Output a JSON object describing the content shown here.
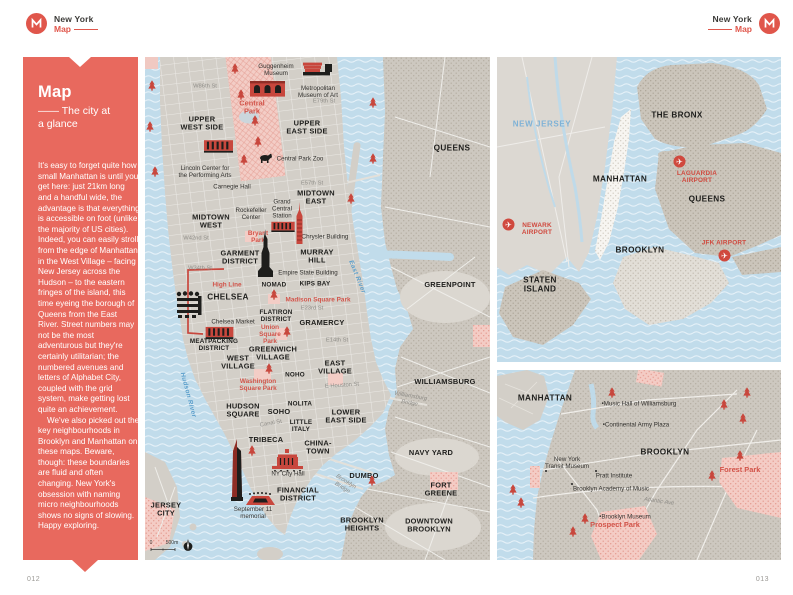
{
  "colors": {
    "accent_red": "#E0564B",
    "sidebar_bg": "#E8695E",
    "water_blue": "#C1DCEB",
    "park_pink": "#F3CDC6",
    "label_red": "#D0493E",
    "water_text_blue": "#5C9FCB"
  },
  "brand": {
    "title": "New York",
    "sub": "Map"
  },
  "pages": {
    "left": "012",
    "right": "013"
  },
  "sidebar": {
    "title": "Map",
    "subtitle": "—— The city at a glance",
    "para1": "It's easy to forget quite how small Manhattan is until you get here: just 21km long and a handful wide, the advantage is that everything is accessible on foot (unlike the majority of US cities). Indeed, you can easily stroll from the edge of Manhattan in the West Village – facing New Jersey across the Hudson – to the eastern fringes of the island, this time eyeing the borough of Queens from the East River. Street numbers may not be the most adventurous but they're certainly utilitarian; the numbered avenues and letters of Alphabet City, coupled with the grid system, make getting lost quite an achievement.",
    "para2": "We've also picked out the key neighbourhoods in Brooklyn and Manhattan on these maps. Beware, though: these boundaries are fluid and often changing. New York's obsession with naming micro neighbourhoods shows no signs of slowing. Happy exploring."
  },
  "main_map": {
    "labels": [
      {
        "t": "UPPER\nWEST SIDE",
        "x": 57,
        "y": 67,
        "c": "n"
      },
      {
        "t": "UPPER\nEAST SIDE",
        "x": 162,
        "y": 71,
        "c": "n"
      },
      {
        "t": "QUEENS",
        "x": 307,
        "y": 91,
        "c": "n2"
      },
      {
        "t": "MIDTOWN\nEAST",
        "x": 171,
        "y": 141,
        "c": "n"
      },
      {
        "t": "MIDTOWN\nWEST",
        "x": 66,
        "y": 165,
        "c": "n"
      },
      {
        "t": "GARMENT\nDISTRICT",
        "x": 95,
        "y": 201,
        "c": "n"
      },
      {
        "t": "MURRAY\nHILL",
        "x": 172,
        "y": 200,
        "c": "n"
      },
      {
        "t": "NOMAD",
        "x": 129,
        "y": 228,
        "c": "nsm"
      },
      {
        "t": "KIPS BAY",
        "x": 170,
        "y": 227,
        "c": "nsm"
      },
      {
        "t": "CHELSEA",
        "x": 83,
        "y": 240,
        "c": "n2"
      },
      {
        "t": "GREENPOINT",
        "x": 305,
        "y": 228,
        "c": "n"
      },
      {
        "t": "FLATIRON\nDISTRICT",
        "x": 131,
        "y": 259,
        "c": "nsm"
      },
      {
        "t": "GRAMERCY",
        "x": 177,
        "y": 266,
        "c": "n"
      },
      {
        "t": "MEATPACKING\nDISTRICT",
        "x": 69,
        "y": 288,
        "c": "nsm"
      },
      {
        "t": "GREENWICH\nVILLAGE",
        "x": 128,
        "y": 297,
        "c": "n"
      },
      {
        "t": "WEST\nVILLAGE",
        "x": 93,
        "y": 306,
        "c": "n"
      },
      {
        "t": "EAST\nVILLAGE",
        "x": 190,
        "y": 311,
        "c": "n"
      },
      {
        "t": "NOHO",
        "x": 150,
        "y": 318,
        "c": "nsm"
      },
      {
        "t": "WILLIAMSBURG",
        "x": 300,
        "y": 325,
        "c": "n"
      },
      {
        "t": "HUDSON\nSQUARE",
        "x": 98,
        "y": 354,
        "c": "n"
      },
      {
        "t": "SOHO",
        "x": 134,
        "y": 355,
        "c": "n"
      },
      {
        "t": "NOLITA",
        "x": 155,
        "y": 347,
        "c": "nsm"
      },
      {
        "t": "LOWER\nEAST SIDE",
        "x": 201,
        "y": 360,
        "c": "n"
      },
      {
        "t": "LITTLE\nITALY",
        "x": 156,
        "y": 369,
        "c": "nsm"
      },
      {
        "t": "TRIBECA",
        "x": 121,
        "y": 383,
        "c": "n"
      },
      {
        "t": "CHINA-\nTOWN",
        "x": 173,
        "y": 391,
        "c": "n"
      },
      {
        "t": "NAVY YARD",
        "x": 286,
        "y": 396,
        "c": "n"
      },
      {
        "t": "DUMBO",
        "x": 219,
        "y": 419,
        "c": "n"
      },
      {
        "t": "FORT\nGREENE",
        "x": 296,
        "y": 433,
        "c": "n"
      },
      {
        "t": "JERSEY\nCITY",
        "x": 21,
        "y": 453,
        "c": "n"
      },
      {
        "t": "FINANCIAL\nDISTRICT",
        "x": 153,
        "y": 438,
        "c": "n"
      },
      {
        "t": "BROOKLYN\nHEIGHTS",
        "x": 217,
        "y": 468,
        "c": "n"
      },
      {
        "t": "DOWNTOWN\nBROOKLYN",
        "x": 284,
        "y": 469,
        "c": "n"
      },
      {
        "t": "W86th St",
        "x": 60,
        "y": 30,
        "c": "s"
      },
      {
        "t": "E79th St",
        "x": 179,
        "y": 45,
        "c": "s"
      },
      {
        "t": "E57th St",
        "x": 167,
        "y": 127,
        "c": "s"
      },
      {
        "t": "W42nd St",
        "x": 51,
        "y": 182,
        "c": "s"
      },
      {
        "t": "W34th St",
        "x": 55,
        "y": 212,
        "c": "s"
      },
      {
        "t": "E23rd St",
        "x": 167,
        "y": 252,
        "c": "s"
      },
      {
        "t": "E14th St",
        "x": 192,
        "y": 284,
        "c": "s"
      },
      {
        "t": "E Houston St",
        "x": 197,
        "y": 329,
        "c": "s",
        "r": -4
      },
      {
        "t": "Canal St",
        "x": 126,
        "y": 367,
        "c": "s",
        "r": -10
      },
      {
        "t": "Brooklyn\nBridge",
        "x": 199,
        "y": 428,
        "c": "b",
        "r": 32
      },
      {
        "t": "Williamsburg\nBridge",
        "x": 265,
        "y": 343,
        "c": "b",
        "r": 10
      },
      {
        "t": "Hudson River",
        "x": 43,
        "y": 338,
        "c": "w",
        "r": 75
      },
      {
        "t": "East River",
        "x": 212,
        "y": 220,
        "c": "w",
        "r": 68
      },
      {
        "t": "Central\nPark",
        "x": 107,
        "y": 51,
        "c": "k2"
      },
      {
        "t": "Bryant\nPark",
        "x": 113,
        "y": 180,
        "c": "k"
      },
      {
        "t": "High Line",
        "x": 82,
        "y": 228,
        "c": "k"
      },
      {
        "t": "Madison Square Park",
        "x": 173,
        "y": 243,
        "c": "k"
      },
      {
        "t": "Union\nSquare\nPark",
        "x": 125,
        "y": 278,
        "c": "k"
      },
      {
        "t": "Washington\nSquare Park",
        "x": 113,
        "y": 328,
        "c": "k"
      },
      {
        "t": "Guggenheim\nMuseum",
        "x": 131,
        "y": 13,
        "c": "p"
      },
      {
        "t": "Metropolitan\nMuseum of Art",
        "x": 173,
        "y": 35,
        "c": "p"
      },
      {
        "t": "Central Park Zoo",
        "x": 155,
        "y": 102,
        "c": "p"
      },
      {
        "t": "Lincoln Center for\nthe Performing Arts",
        "x": 60,
        "y": 115,
        "c": "p"
      },
      {
        "t": "Carnegie Hall",
        "x": 87,
        "y": 130,
        "c": "p"
      },
      {
        "t": "Rockefeller\nCenter",
        "x": 106,
        "y": 157,
        "c": "p"
      },
      {
        "t": "Grand\nCentral\nStation",
        "x": 137,
        "y": 152,
        "c": "p"
      },
      {
        "t": "Chrysler Building",
        "x": 180,
        "y": 180,
        "c": "p"
      },
      {
        "t": "Empire State Building",
        "x": 163,
        "y": 216,
        "c": "p"
      },
      {
        "t": "Chelsea Market",
        "x": 88,
        "y": 265,
        "c": "p"
      },
      {
        "t": "NY City Hall",
        "x": 143,
        "y": 417,
        "c": "p"
      },
      {
        "t": "September 11\nmemorial",
        "x": 108,
        "y": 456,
        "c": "p"
      },
      {
        "t": "0",
        "x": 6,
        "y": 487,
        "c": "sc"
      },
      {
        "t": "500m",
        "x": 27,
        "y": 487,
        "c": "sc"
      }
    ],
    "icons": [
      {
        "n": "guggenheim-museum-icon",
        "s": "guggenheim",
        "x": 158,
        "y": 3,
        "w": 30,
        "h": 17
      },
      {
        "n": "metropolitan-museum-icon",
        "s": "bldg-arch",
        "x": 105,
        "y": 23,
        "w": 35,
        "h": 17
      },
      {
        "n": "lincoln-center-icon",
        "s": "bldg-stripe",
        "x": 59,
        "y": 81,
        "w": 29,
        "h": 16
      },
      {
        "n": "central-park-zoo-bear-icon",
        "s": "bear",
        "x": 114,
        "y": 96,
        "w": 13,
        "h": 10
      },
      {
        "n": "midtown-highrise-icon",
        "s": "highrise-red",
        "x": 107,
        "y": 103,
        "w": 22,
        "h": 46
      },
      {
        "n": "grand-central-icon",
        "s": "bldg-stripe",
        "x": 126,
        "y": 164,
        "w": 24,
        "h": 11
      },
      {
        "n": "chrysler-building-icon",
        "s": "tower-red",
        "x": 149,
        "y": 145,
        "w": 11,
        "h": 42
      },
      {
        "n": "empire-state-building-icon",
        "s": "tower-black",
        "x": 113,
        "y": 172,
        "w": 15,
        "h": 48
      },
      {
        "n": "whitney-museum-icon",
        "s": "bldg-stripe",
        "x": 56,
        "y": 269,
        "w": 37,
        "h": 13
      },
      {
        "n": "chelsea-piers-icon",
        "s": "pier",
        "x": 31,
        "y": 234,
        "w": 27,
        "h": 29
      },
      {
        "n": "one-wtc-icon",
        "s": "tower-wtc",
        "x": 84,
        "y": 382,
        "w": 16,
        "h": 62
      },
      {
        "n": "september-11-memorial-icon",
        "s": "memorial",
        "x": 99,
        "y": 435,
        "w": 33,
        "h": 15
      },
      {
        "n": "ny-city-hall-icon",
        "s": "cityhall",
        "x": 127,
        "y": 392,
        "w": 31,
        "h": 23
      },
      {
        "n": "compass-icon",
        "s": "compass",
        "x": 37,
        "y": 482,
        "w": 12,
        "h": 13
      }
    ],
    "trees": [
      [
        7,
        33
      ],
      [
        5,
        74
      ],
      [
        10,
        119
      ],
      [
        90,
        16
      ],
      [
        96,
        42
      ],
      [
        110,
        68
      ],
      [
        113,
        89
      ],
      [
        99,
        107
      ],
      [
        228,
        50
      ],
      [
        228,
        106
      ],
      [
        206,
        146
      ],
      [
        129,
        242
      ],
      [
        142,
        279
      ],
      [
        124,
        316
      ],
      [
        107,
        398
      ],
      [
        227,
        428
      ]
    ]
  },
  "overview_map": {
    "labels": [
      {
        "t": "NEW JERSEY",
        "x": 45,
        "y": 67,
        "c": "w2"
      },
      {
        "t": "THE BRONX",
        "x": 180,
        "y": 58,
        "c": "n2"
      },
      {
        "t": "MANHATTAN",
        "x": 123,
        "y": 122,
        "c": "n2"
      },
      {
        "t": "LAGUARDIA\nAIRPORT",
        "x": 200,
        "y": 120,
        "c": "a"
      },
      {
        "t": "QUEENS",
        "x": 210,
        "y": 142,
        "c": "n2"
      },
      {
        "t": "NEWARK\nAIRPORT",
        "x": 40,
        "y": 172,
        "c": "a"
      },
      {
        "t": "BROOKLYN",
        "x": 143,
        "y": 193,
        "c": "n2"
      },
      {
        "t": "STATEN\nISLAND",
        "x": 43,
        "y": 228,
        "c": "n2"
      },
      {
        "t": "JFK AIRPORT",
        "x": 227,
        "y": 186,
        "c": "a"
      }
    ],
    "icons": [
      {
        "n": "laguardia-airport-icon",
        "s": "plane-badge",
        "x": 176,
        "y": 98,
        "w": 13,
        "h": 13
      },
      {
        "n": "newark-airport-icon",
        "s": "plane-badge",
        "x": 5,
        "y": 161,
        "w": 13,
        "h": 13
      },
      {
        "n": "jfk-airport-icon",
        "s": "plane-badge",
        "x": 221,
        "y": 192,
        "w": 13,
        "h": 13
      }
    ],
    "trees": []
  },
  "brooklyn_map": {
    "labels": [
      {
        "t": "MANHATTAN",
        "x": 48,
        "y": 28,
        "c": "n2"
      },
      {
        "t": "BROOKLYN",
        "x": 168,
        "y": 82,
        "c": "n2"
      },
      {
        "t": "•Music Hall of Williamsburg",
        "x": 142,
        "y": 34,
        "c": "p"
      },
      {
        "t": "•Continental Army Plaza",
        "x": 139,
        "y": 55,
        "c": "p"
      },
      {
        "t": "New York\nTransit Museum",
        "x": 70,
        "y": 93,
        "c": "p"
      },
      {
        "t": "Pratt Institute",
        "x": 117,
        "y": 106,
        "c": "p"
      },
      {
        "t": "Brooklyn Academy of Music",
        "x": 114,
        "y": 119,
        "c": "p"
      },
      {
        "t": "Atlantic Ave",
        "x": 162,
        "y": 132,
        "c": "b",
        "r": 8
      },
      {
        "t": "•Brooklyn Museum",
        "x": 128,
        "y": 147,
        "c": "p"
      },
      {
        "t": "Prospect Park",
        "x": 118,
        "y": 155,
        "c": "k2"
      },
      {
        "t": "Forest Park",
        "x": 243,
        "y": 100,
        "c": "k2"
      }
    ],
    "icons": [],
    "trees": [
      [
        115,
        27
      ],
      [
        227,
        39
      ],
      [
        250,
        27
      ],
      [
        246,
        53
      ],
      [
        243,
        90
      ],
      [
        16,
        124
      ],
      [
        24,
        137
      ],
      [
        88,
        153
      ],
      [
        76,
        166
      ],
      [
        215,
        110
      ]
    ],
    "dots": [
      [
        48,
        100
      ],
      [
        98,
        100
      ],
      [
        74,
        113
      ]
    ]
  }
}
